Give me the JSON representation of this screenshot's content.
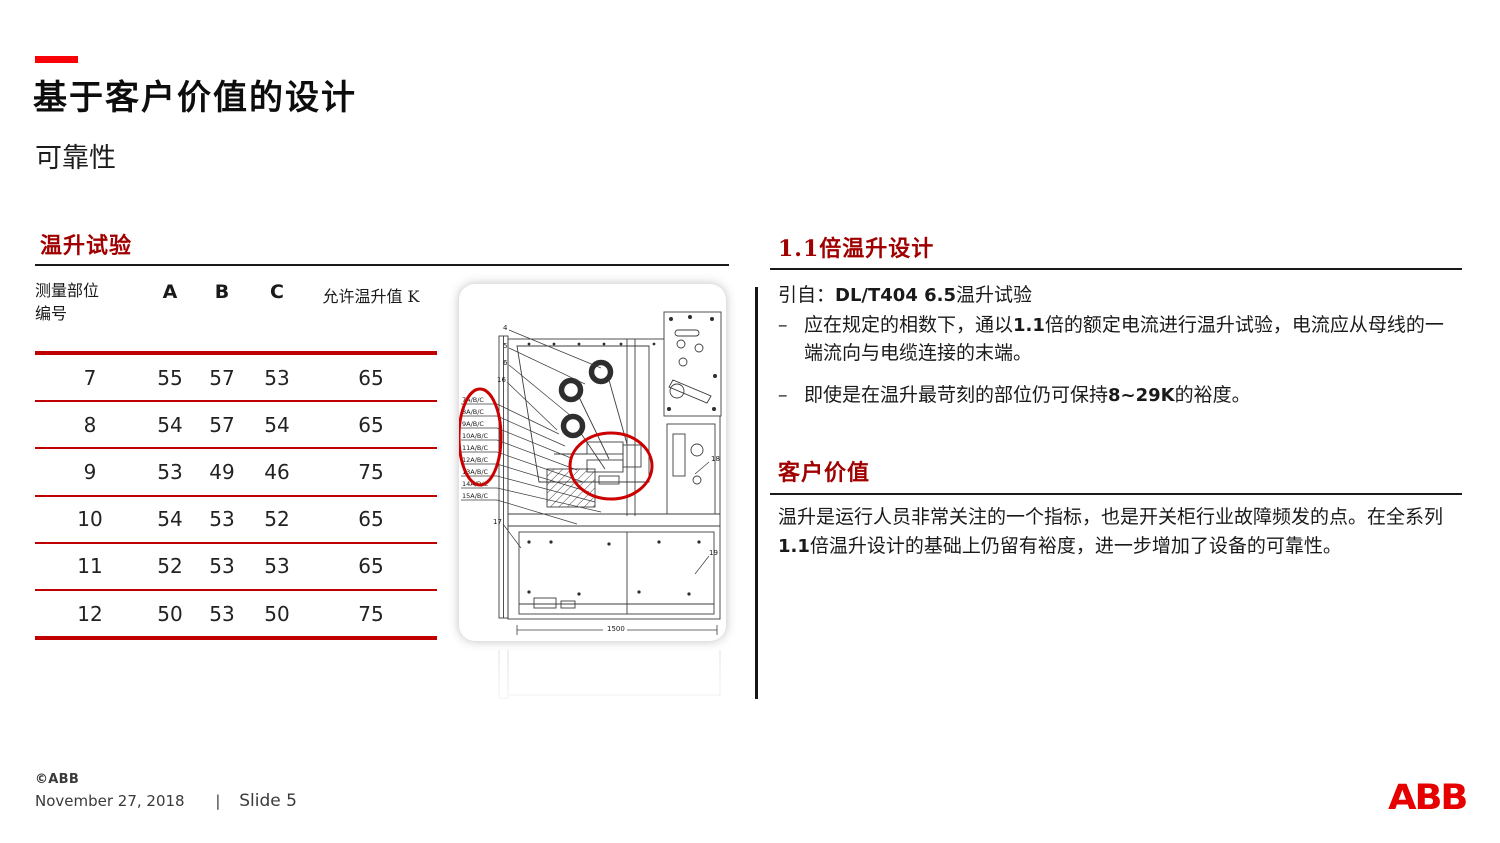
{
  "slide": {
    "title": "基于客户价值的设计",
    "subtitle": "可靠性"
  },
  "left_section": {
    "heading": "温升试验",
    "table": {
      "header": {
        "part_line1": "测量部位",
        "part_line2": "编号",
        "a": "A",
        "b": "B",
        "c": "C",
        "allowed": "允许温升值 K"
      },
      "rows": [
        {
          "id": "7",
          "a": "55",
          "b": "57",
          "c": "53",
          "k": "65"
        },
        {
          "id": "8",
          "a": "54",
          "b": "57",
          "c": "54",
          "k": "65"
        },
        {
          "id": "9",
          "a": "53",
          "b": "49",
          "c": "46",
          "k": "75"
        },
        {
          "id": "10",
          "a": "54",
          "b": "53",
          "c": "52",
          "k": "65"
        },
        {
          "id": "11",
          "a": "52",
          "b": "53",
          "c": "53",
          "k": "65"
        },
        {
          "id": "12",
          "a": "50",
          "b": "53",
          "c": "50",
          "k": "75"
        }
      ]
    }
  },
  "drawing": {
    "labels": [
      "7A/B/C",
      "8A/B/C",
      "9A/B/C",
      "10A/B/C",
      "11A/B/C",
      "12A/B/C",
      "13A/B/C",
      "14A/B/C",
      "15A/B/C"
    ],
    "callouts": [
      "4",
      "5",
      "6",
      "16",
      "17",
      "18",
      "19"
    ],
    "dimension": "1500"
  },
  "right_section": {
    "design": {
      "heading": "1.1倍温升设计",
      "source_pre": "引自：",
      "source_strong": "DL/T404 6.5",
      "source_post": "温升试验",
      "bullet_marker": "–",
      "bullets": [
        {
          "pre": "应在规定的相数下，通以",
          "strong": "1.1",
          "post": "倍的额定电流进行温升试验，电流应从母线的一端流向与电缆连接的末端。"
        },
        {
          "pre": "即使是在温升最苛刻的部位仍可保持",
          "strong": "8~29K",
          "post": "的裕度。"
        }
      ]
    },
    "value": {
      "heading": "客户价值",
      "body_pre": "温升是运行人员非常关注的一个指标，也是开关柜行业故障频发的点。在全系列",
      "body_strong": "1.1",
      "body_post": "倍温升设计的基础上仍留有裕度，进一步增加了设备的可靠性。"
    }
  },
  "footer": {
    "copyright": "©ABB",
    "date": "November 27, 2018",
    "separator": "|",
    "slide_label": "Slide 5",
    "logo": "ABB"
  },
  "colors": {
    "accent_red": "#fb0007",
    "heading_red": "#a00000",
    "table_line_red": "#c00000",
    "annotation_red": "#cc0000",
    "logo_red": "#e60000"
  }
}
